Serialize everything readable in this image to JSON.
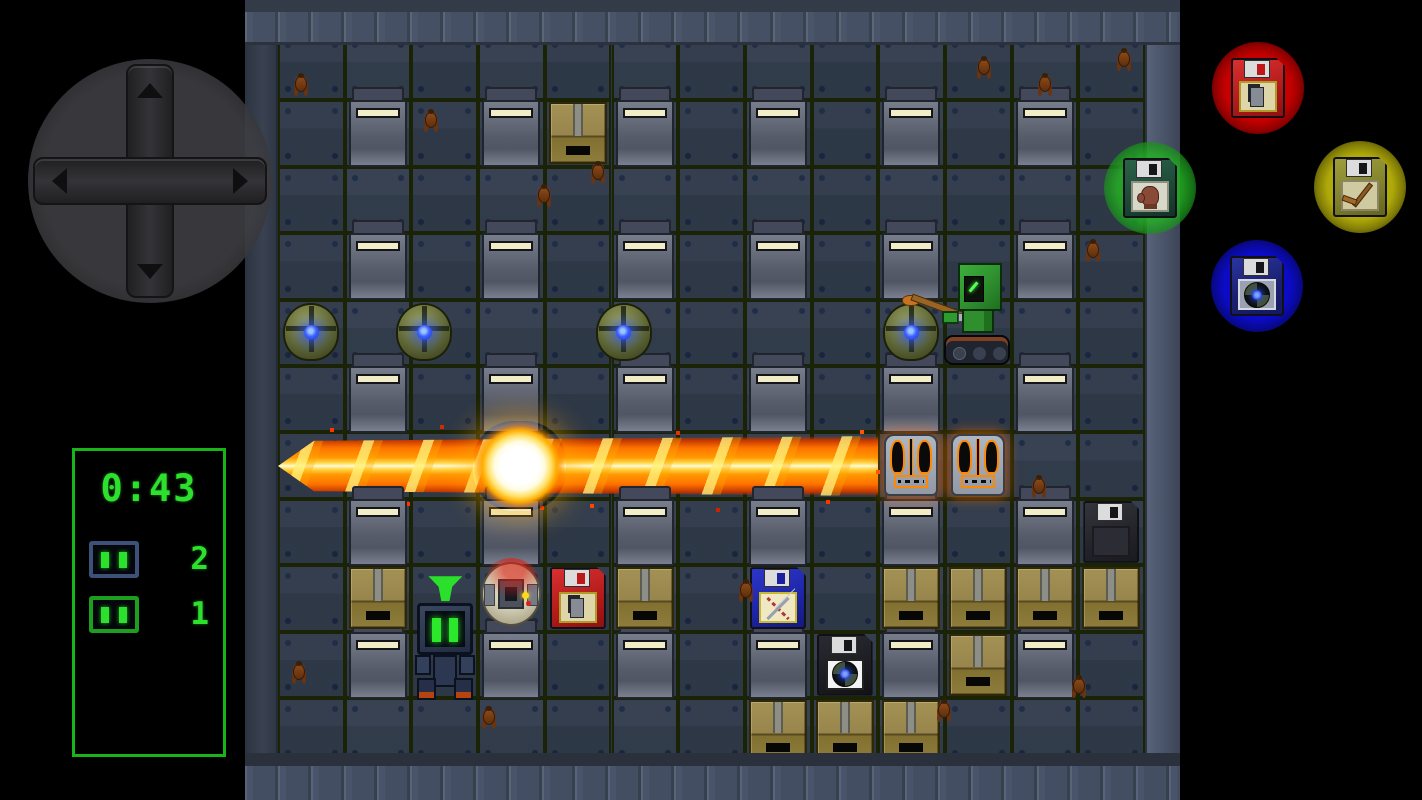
{
  "hud": {
    "timer": "0:43",
    "counters": [
      {
        "icon": "blue-robot-head",
        "value": "2"
      },
      {
        "icon": "green-robot-head",
        "value": "1"
      }
    ],
    "accent_color": "#2ee02e"
  },
  "controls": {
    "dpad": {
      "directions": [
        "up",
        "down",
        "left",
        "right"
      ]
    },
    "buttons": [
      {
        "id": "red",
        "icon": "radio-floppy-icon",
        "color": "#cd0000",
        "fd": "fd-red",
        "fdicon": "walkie"
      },
      {
        "id": "green",
        "icon": "glove-floppy-icon",
        "color": "#23af23",
        "fd": "fd-green",
        "fdicon": "glove"
      },
      {
        "id": "yellow",
        "icon": "stick-floppy-icon",
        "color": "#b9b20a",
        "fd": "fd-yellow",
        "fdicon": "stick"
      },
      {
        "id": "blue",
        "icon": "bomb-floppy-icon",
        "color": "#0c0cd2",
        "fd": "fd-navy",
        "fdicon": "fan"
      }
    ]
  },
  "board": {
    "cols": 13,
    "rows": 11,
    "blocks": [
      [
        2,
        2
      ],
      [
        2,
        4
      ],
      [
        2,
        6
      ],
      [
        2,
        8
      ],
      [
        2,
        10
      ],
      [
        2,
        12
      ],
      [
        4,
        2
      ],
      [
        4,
        4
      ],
      [
        4,
        6
      ],
      [
        4,
        8
      ],
      [
        4,
        10
      ],
      [
        4,
        12
      ],
      [
        6,
        2
      ],
      [
        6,
        4
      ],
      [
        6,
        6
      ],
      [
        6,
        8
      ],
      [
        6,
        10
      ],
      [
        6,
        12
      ],
      [
        8,
        2
      ],
      [
        8,
        4
      ],
      [
        8,
        6
      ],
      [
        8,
        8
      ],
      [
        8,
        10
      ],
      [
        8,
        12
      ],
      [
        10,
        2
      ],
      [
        10,
        4
      ],
      [
        10,
        6
      ],
      [
        10,
        8
      ],
      [
        10,
        10
      ],
      [
        10,
        12
      ]
    ],
    "crates": [
      [
        2,
        5
      ],
      [
        9,
        2
      ],
      [
        9,
        6
      ],
      [
        9,
        10
      ],
      [
        9,
        11
      ],
      [
        9,
        12
      ],
      [
        9,
        13
      ],
      [
        10,
        11
      ],
      [
        11,
        8
      ],
      [
        11,
        9
      ],
      [
        11,
        10
      ]
    ],
    "bombs": [
      {
        "r": 5,
        "c": 1,
        "dx": 0
      },
      {
        "r": 5,
        "c": 3,
        "dx": -20
      },
      {
        "r": 5,
        "c": 6,
        "dx": -21
      },
      {
        "r": 5,
        "c": 10,
        "dx": 0
      }
    ],
    "items": [
      {
        "r": 8,
        "c": 13,
        "type": "fd-blackplain",
        "icon": "none",
        "name": "pickup-floppy-black"
      },
      {
        "r": 9,
        "c": 5,
        "type": "fd-red",
        "icon": "walkie",
        "name": "pickup-floppy-red-detonator"
      },
      {
        "r": 9,
        "c": 8,
        "type": "fd-blue",
        "icon": "x",
        "name": "pickup-floppy-blue-cross"
      },
      {
        "r": 10,
        "c": 9,
        "type": "fd-fan",
        "icon": "fan",
        "name": "pickup-floppy-bomb-up"
      }
    ],
    "burning_enemies": [
      [
        7,
        10
      ],
      [
        7,
        11
      ]
    ],
    "actors": {
      "player": {
        "r": 5,
        "c": 11,
        "desc": "green tank robot with hockey stick"
      },
      "enemy_robot": {
        "r": 9,
        "c": 3,
        "marker": true,
        "desc": "dark robot with green eyes"
      },
      "damaged_robot": {
        "r": 9,
        "c": 4,
        "desc": "white sphere robot on fire"
      }
    },
    "explosion": {
      "row": 7,
      "from_col": 1,
      "to_col": 9,
      "center_col": 4
    },
    "roaches": [
      [
        290,
        72
      ],
      [
        973,
        55
      ],
      [
        1113,
        47
      ],
      [
        420,
        108
      ],
      [
        1034,
        72
      ],
      [
        533,
        183
      ],
      [
        587,
        160
      ],
      [
        1082,
        238
      ],
      [
        1028,
        474
      ],
      [
        735,
        578
      ],
      [
        288,
        660
      ],
      [
        1068,
        674
      ],
      [
        478,
        705
      ],
      [
        933,
        698
      ]
    ]
  },
  "palette": {
    "floor": "#2c3644",
    "gridline": "#1b2306",
    "wall": "#4a5468",
    "beam_core": "#fffbd8",
    "beam_body": "#ff7300",
    "bomb_glow": "#3c64ff"
  }
}
